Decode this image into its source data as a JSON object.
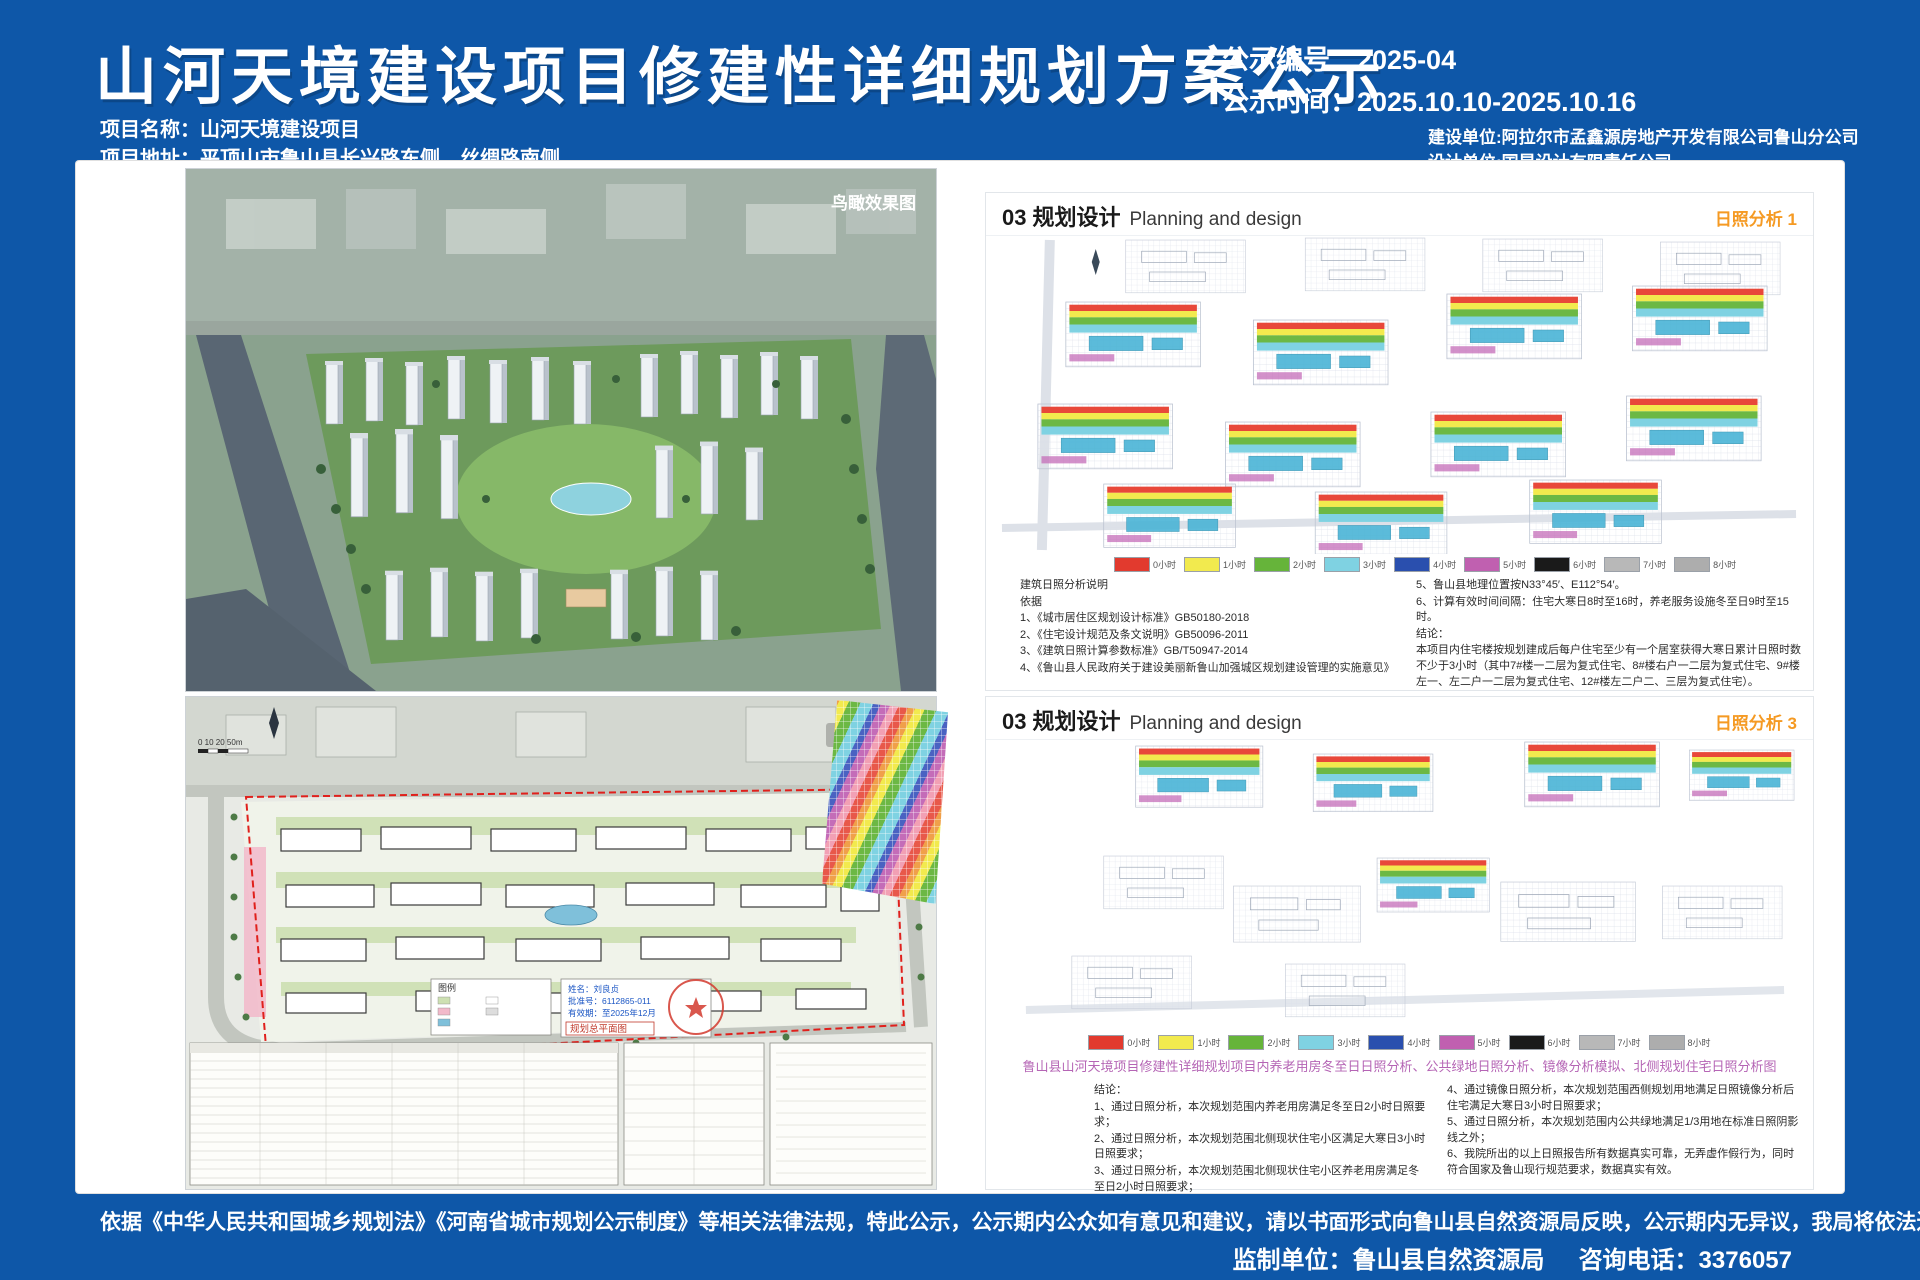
{
  "header": {
    "title": "山河天境建设项目修建性详细规划方案公示",
    "notice_no": "公示编号：2025-04",
    "notice_time": "公示时间：2025.10.10-2025.10.16",
    "project_name": "项目名称：山河天境建设项目",
    "project_addr": "项目地址：平顶山市鲁山县长兴路东侧、丝绸路南侧",
    "builder": "建设单位:阿拉尔市孟鑫源房地产开发有限公司鲁山分公司",
    "designer": "设计单位:国昇设计有限责任公司"
  },
  "aerial": {
    "caption": "鸟瞰效果图"
  },
  "siteplan": {
    "caption": "总平面图",
    "scale_text": "0  10  20       50m",
    "legend_title": "图例",
    "stamp_title": "规划总平面图",
    "cert_name": "姓名：刘良贞",
    "cert_no": "批准号：6112865-011",
    "cert_valid": "有效期：至2025年12月"
  },
  "panel1": {
    "section_no": "03",
    "section_title": "规划设计",
    "section_en": "Planning and design",
    "tag": "日照分析 1",
    "notes_title": "建筑日照分析说明",
    "notes_basis": "依据",
    "notes_left": [
      "1、《城市居住区规划设计标准》GB50180-2018",
      "2、《住宅设计规范及条文说明》GB50096-2011",
      "3、《建筑日照计算参数标准》GB/T50947-2014",
      "4、《鲁山县人民政府关于建设美丽新鲁山加强城区规划建设管理的实施意见》"
    ],
    "notes_right": [
      "5、鲁山县地理位置按N33°45′、E112°54′。",
      "6、计算有效时间间隔：住宅大寒日8时至16时，养老服务设施冬至日9时至15时。"
    ],
    "conclusion_title": "结论：",
    "conclusion": "本项目内住宅楼按规划建成后每户住宅至少有一个居室获得大寒日累计日照时数不少于3小时（其中7#楼一二层为复式住宅、8#楼右户一二层为复式住宅、9#楼左一、左二户一二层为复式住宅、12#楼左二户二、三层为复式住宅）。"
  },
  "panel2": {
    "section_no": "03",
    "section_title": "规划设计",
    "section_en": "Planning and design",
    "tag": "日照分析 3",
    "caption": "鲁山县山河天境项目修建性详细规划项目内养老用房冬至日日照分析、公共绿地日照分析、镜像分析模拟、北侧规划住宅日照分析图",
    "conclusion_title": "结论：",
    "conclusions_left": [
      "1、通过日照分析，本次规划范围内养老用房满足冬至日2小时日照要求；",
      "2、通过日照分析，本次规划范围北侧现状住宅小区满足大寒日3小时日照要求；",
      "3、通过日照分析，本次规划范围北侧现状住宅小区养老用房满足冬至日2小时日照要求；"
    ],
    "conclusions_right": [
      "4、通过镜像日照分析，本次规划范围西侧规划用地满足日照镜像分析后住宅满足大寒日3小时日照要求；",
      "5、通过日照分析，本次规划范围内公共绿地满足1/3用地在标准日照阴影线之外；",
      "6、我院所出的以上日照报告所有数据真实可靠，无弄虚作假行为，同时符合国家及鲁山现行规范要求，数据真实有效。"
    ]
  },
  "sunshine_legend": {
    "items": [
      {
        "label": "0小时",
        "color": "#e23a2e"
      },
      {
        "label": "1小时",
        "color": "#f2ea4e"
      },
      {
        "label": "2小时",
        "color": "#66b43a"
      },
      {
        "label": "3小时",
        "color": "#7fd2e2"
      },
      {
        "label": "4小时",
        "color": "#2a4fae"
      },
      {
        "label": "5小时",
        "color": "#c060b0"
      },
      {
        "label": "6小时",
        "color": "#1a1a1a"
      },
      {
        "label": "7小时",
        "color": "#b8b8b8"
      },
      {
        "label": "8小时",
        "color": "#adadad"
      }
    ]
  },
  "footer": {
    "legal": "依据《中华人民共和国城乡规划法》《河南省城市规划公示制度》等相关法律法规，特此公示，公示期内公众如有意见和建议，请以书面形式向鲁山县自然资源局反映，公示期内无异议，我局将依法进入规划许可程序。",
    "supervisor": "监制单位：鲁山县自然资源局",
    "phone": "咨询电话：3376057"
  },
  "colors": {
    "background": "#0e57a8",
    "accent_orange": "#f59a23",
    "caption_purple": "#b565b5"
  }
}
